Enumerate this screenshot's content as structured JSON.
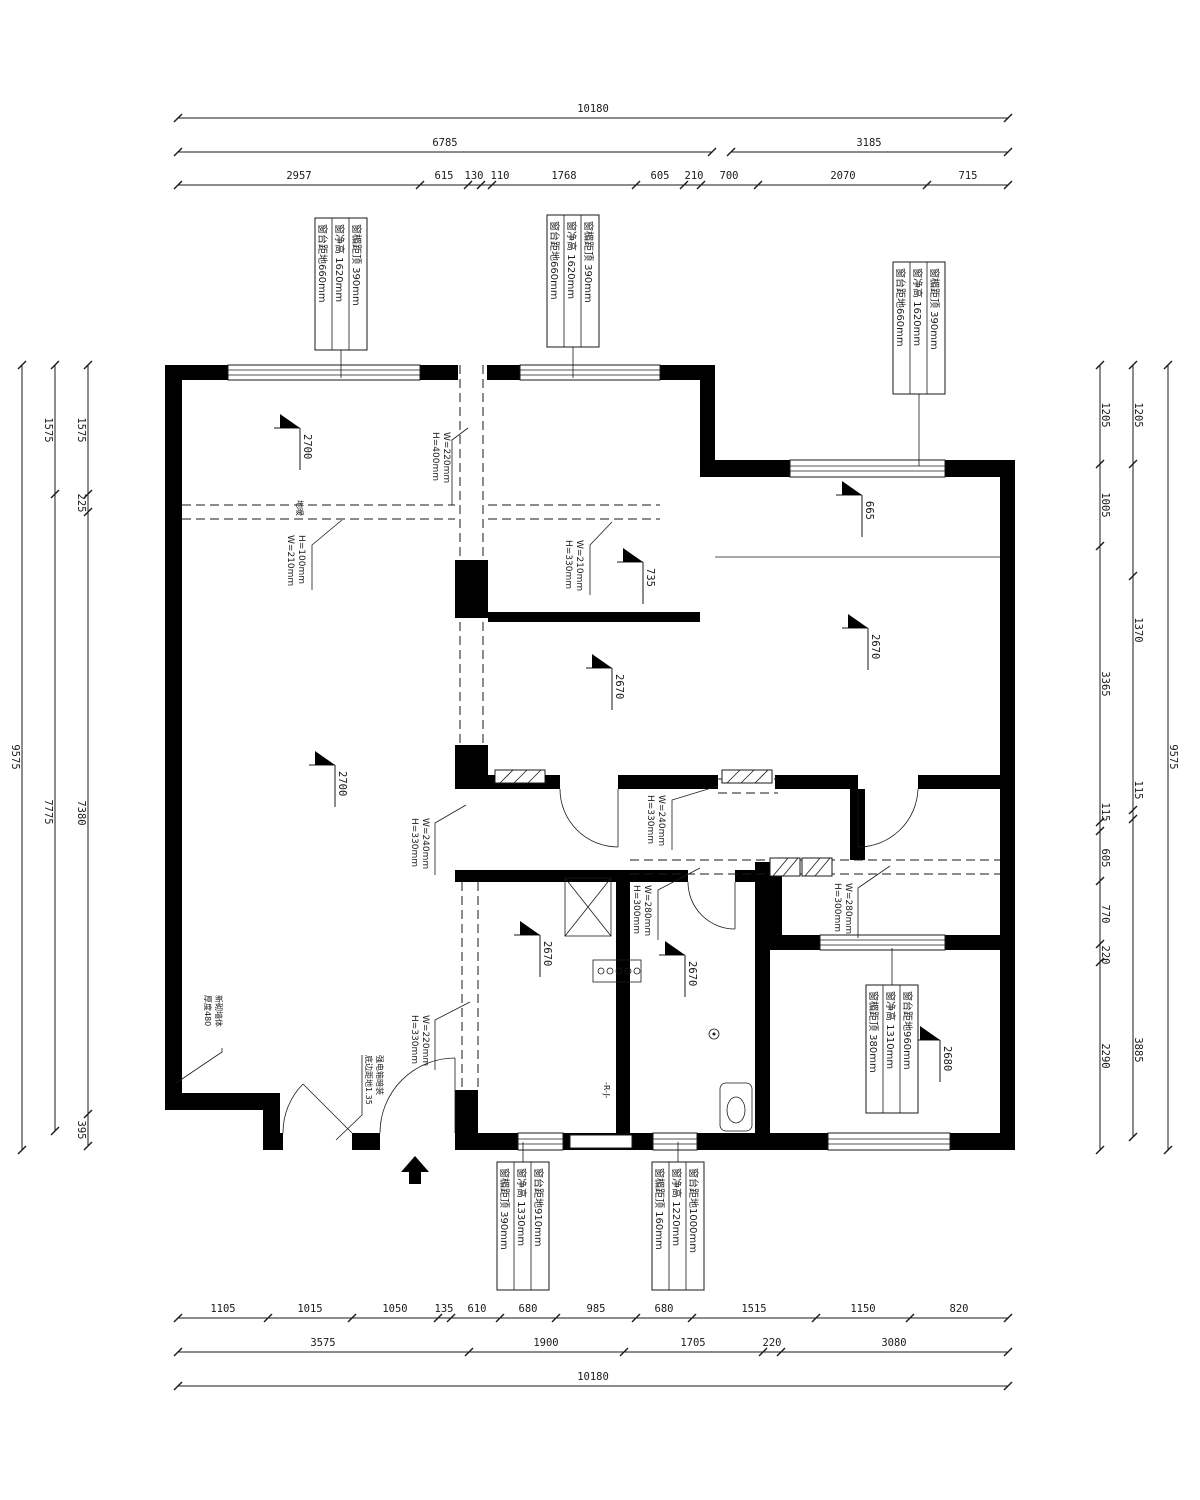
{
  "drawing_type": "floor-plan",
  "dims": {
    "top": {
      "total": "10180",
      "mid": [
        "6785",
        "3185"
      ],
      "detail": [
        "2957",
        "615",
        "130",
        "110",
        "1768",
        "605",
        "210",
        "700",
        "2070",
        "715"
      ]
    },
    "bottom": {
      "detail": [
        "1105",
        "1015",
        "1050",
        "135",
        "610",
        "680",
        "985",
        "680",
        "1515",
        "1150",
        "820"
      ],
      "mid": [
        "3575",
        "1900",
        "1705",
        "220",
        "3080"
      ],
      "total": "10180"
    },
    "left": {
      "total": "9575",
      "mid": [
        "1575",
        "7775"
      ],
      "detail": [
        "1575",
        "225",
        "7380",
        "395"
      ]
    },
    "right": {
      "total": "9575",
      "mid": [
        "1205",
        "1370",
        "115",
        "3885"
      ],
      "detail": [
        "1205",
        "1005",
        "3365",
        "115",
        "605",
        "770",
        "220",
        "2290"
      ]
    }
  },
  "window_specs": {
    "top_left": {
      "lines": [
        "窗楣距顶 390mm",
        "窗净高 1620mm",
        "窗台距地660mm"
      ]
    },
    "top_middle": {
      "lines": [
        "窗楣距顶 390mm",
        "窗净高 1620mm",
        "窗台距地660mm"
      ]
    },
    "top_right": {
      "lines": [
        "窗楣距顶 390mm",
        "窗净高 1620mm",
        "窗台距地660mm"
      ]
    },
    "right_bottom": {
      "lines": [
        "窗台距地960mm",
        "窗净高 1310mm",
        "窗楣距顶 380mm"
      ]
    },
    "bottom_left": {
      "lines": [
        "窗台距地910mm",
        "窗净高 1330mm",
        "窗楣距顶 390mm"
      ]
    },
    "bottom_right": {
      "lines": [
        "窗台距地1000mm",
        "窗净高 1220mm",
        "窗楣距顶 160mm"
      ]
    }
  },
  "beams": [
    {
      "l1": "W=220mm",
      "l2": "H=400mm"
    },
    {
      "l1": "H=100mm",
      "l2": "W=210mm"
    },
    {
      "l1": "W=210mm",
      "l2": "H=330mm"
    },
    {
      "l1": "W=240mm",
      "l2": "H=330mm"
    },
    {
      "l1": "W=240mm",
      "l2": "H=330mm"
    },
    {
      "l1": "W=280mm",
      "l2": "H=300mm"
    },
    {
      "l1": "W=280mm",
      "l2": "H=300mm"
    },
    {
      "l1": "W=220mm",
      "l2": "H=330mm"
    }
  ],
  "levels": [
    "2700",
    "735",
    "2670",
    "665",
    "2670",
    "2700",
    "2670",
    "2670",
    "2680"
  ],
  "notes": {
    "floor_heating": "地暖",
    "wall_note": [
      "新砌墙体",
      "厚度480"
    ],
    "elec_note": [
      "强电箱暗装",
      "底边距地1.35"
    ],
    "riser": "-R-J-"
  }
}
